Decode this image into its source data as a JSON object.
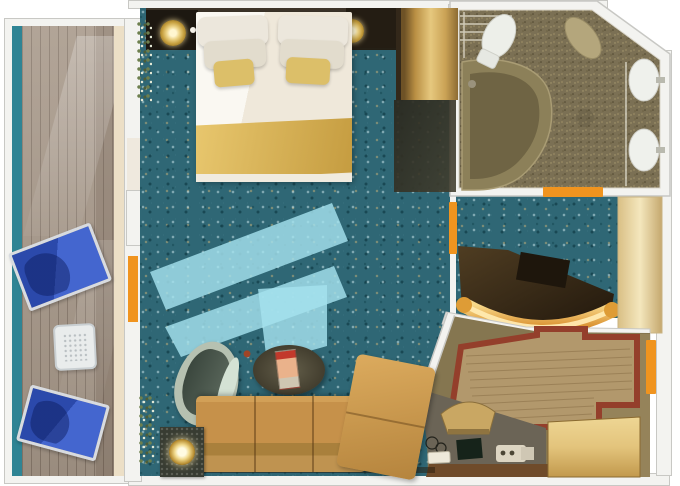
{
  "colors": {
    "wall": "#f3f3f0",
    "wall_line": "#c8c8c4",
    "rail_teal": "#2f8494",
    "deck_wood": "#a79889",
    "divider_cream": "#ecdfc6",
    "lounger_blue": "#2b49ab",
    "lounger_blue_light": "#4466cf",
    "frame_silver": "#d8dbdf",
    "carpet_teal": "#2f6775",
    "sun_streak": "#a5e2ee",
    "headboard_brown": "#352d22",
    "bed_white": "#f6f3ec",
    "pillow_gold": "#dcbf69",
    "blanket_gold": "#d1ab4f",
    "lamp_gold": "#d9b348",
    "wardrobe_gold": "#d9b968",
    "bath_floor": "#7b7054",
    "fixture_white": "#edefe9",
    "fixture_beige": "#b4a67c",
    "tub_rim": "#8c8059",
    "tub_inner": "#6f6444",
    "door_orange": "#f0941f",
    "sofa_tan": "#c6914a",
    "chair_sage": "#b6c1b1",
    "chair_inner": "#46534a",
    "coffee_table": "#45402f",
    "entry_olive": "#857650",
    "entry_wood": "#b2986c",
    "inlay_red": "#943f2b",
    "counter_grey": "#6b6456",
    "counter_edge": "#6f4b2a",
    "glow_gold": "#f6cd72",
    "cabinet_cream": "#e9d7a4"
  },
  "floorplan": {
    "type": "cruise-suite-cabin-top-view",
    "rooms": [
      {
        "name": "balcony",
        "items": [
          "railing",
          "wood-deck",
          "lounge-chair",
          "lounge-chair",
          "side-table"
        ]
      },
      {
        "name": "bedroom-living",
        "items": [
          "double-bed",
          "white-pillows",
          "gold-pillows",
          "gold-runner",
          "wall-lamp",
          "wall-lamp",
          "nightstand",
          "nightstand",
          "gold-wardrobe",
          "desk",
          "armchair",
          "coffee-table",
          "magazine",
          "sofa",
          "chaise",
          "lamp-side-table",
          "plant",
          "plant",
          "sunlight-streaks",
          "balcony-door-curtain"
        ]
      },
      {
        "name": "bathroom",
        "items": [
          "toilet",
          "bidet",
          "bathtub",
          "sink",
          "sink",
          "shower-rails",
          "doorway"
        ]
      },
      {
        "name": "dressing-area",
        "items": [
          "lit-vanity-counter",
          "stool",
          "cream-cabinet",
          "doorway"
        ]
      },
      {
        "name": "entryway",
        "items": [
          "inlaid-wood-floor",
          "red-border-inlay",
          "bench",
          "luggage-counter",
          "counter-items",
          "gold-wardrobe",
          "entry-door"
        ]
      }
    ]
  }
}
